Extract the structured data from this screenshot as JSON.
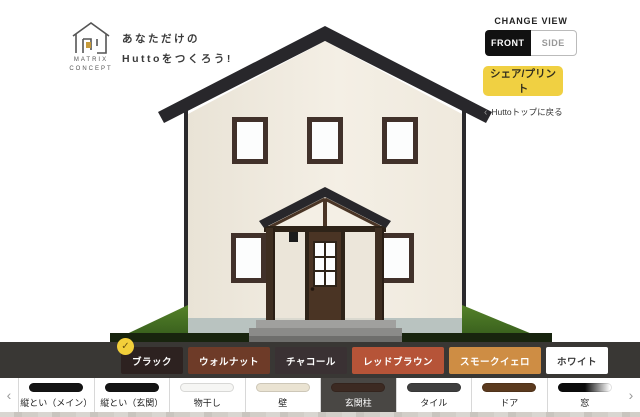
{
  "brand": {
    "name_line1": "MATRIX",
    "name_line2": "CONCEPT",
    "tagline_line1": "あなただけの",
    "tagline_line2": "Huttoをつくろう!"
  },
  "view_switcher": {
    "label": "CHANGE VIEW",
    "options": [
      {
        "label": "FRONT",
        "selected": true
      },
      {
        "label": "SIDE",
        "selected": false
      }
    ]
  },
  "actions": {
    "share_button": "シェア/プリント",
    "back_chevron": "‹",
    "back_link": "Huttoトップに戻る"
  },
  "colors": {
    "accent_yellow": "#f0d042",
    "bar_background": "#393734",
    "selected_tab_background": "#494744",
    "check_badge": "#f2cf3a",
    "check_glyph": "✓"
  },
  "house": {
    "roof": "#28272b",
    "wall_light": "#f4efe5",
    "wall_dark": "#e9e3d6",
    "window_frame": "#41312a",
    "glass": "#fcfdfd",
    "door": "#4a3424",
    "door_frame": "#2e2318",
    "porch_beam": "#4a3526",
    "post": "#3e2e21",
    "foundation": "#b9c3c0",
    "grass_light": "#558229",
    "grass_dark": "#33591b",
    "grass_shadow": "#18240e",
    "downspout": "#2a292c",
    "step_top": "#a0a09e",
    "step_front": "#8b8b89",
    "lamp": "#1b1b1b"
  },
  "swatch_bar": {
    "options": [
      {
        "label": "ブラック",
        "color": "#2d2220",
        "text_color": "#ffffff",
        "selected": true
      },
      {
        "label": "ウォルナット",
        "color": "#6e3b28",
        "text_color": "#ffffff",
        "selected": false
      },
      {
        "label": "チャコール",
        "color": "#3a3133",
        "text_color": "#ffffff",
        "selected": false
      },
      {
        "label": "レッドブラウン",
        "color": "#b65438",
        "text_color": "#ffffff",
        "selected": false
      },
      {
        "label": "スモークイェロ",
        "color": "#ce8d44",
        "text_color": "#ffffff",
        "selected": false
      },
      {
        "label": "ホワイト",
        "color": "#ffffff",
        "text_color": "#3a3a3a",
        "selected": false
      }
    ]
  },
  "tab_bar": {
    "prev_chevron": "‹",
    "next_chevron": "›",
    "tabs": [
      {
        "label": "縦とい（メイン）",
        "swatch": "#141414",
        "selected": false
      },
      {
        "label": "縦とい（玄関）",
        "swatch": "#141414",
        "selected": false
      },
      {
        "label": "物干し",
        "swatch": "#f6f6f4",
        "selected": false
      },
      {
        "label": "壁",
        "swatch": "#eae3d2",
        "selected": false
      },
      {
        "label": "玄関柱",
        "swatch": "#3c2a22",
        "selected": true
      },
      {
        "label": "タイル",
        "swatch": "#3f3f3f",
        "selected": false
      },
      {
        "label": "ドア",
        "swatch": "#5b3a1e",
        "selected": false
      },
      {
        "label": "窓",
        "swatch": "linear-gradient(90deg,#0c0c0c 50%,rgba(12,12,12,0) 96%)",
        "selected": false
      }
    ]
  }
}
